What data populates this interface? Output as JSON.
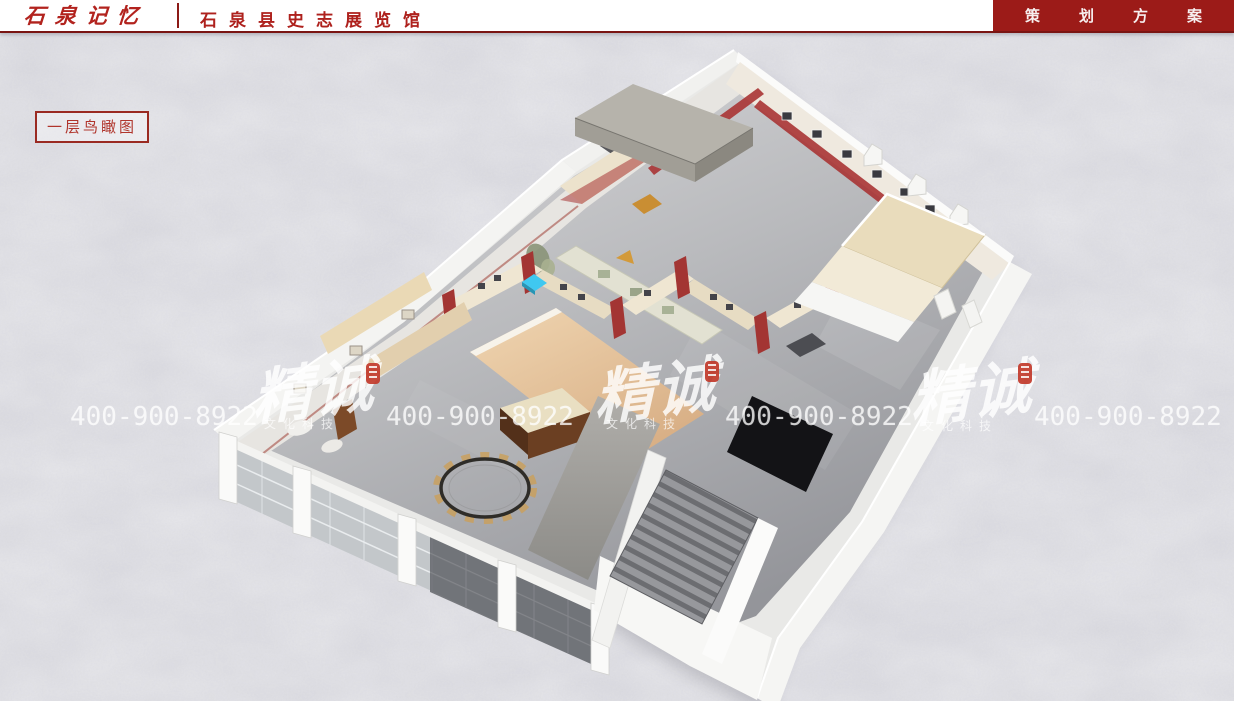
{
  "header": {
    "logo_text": "石泉记忆",
    "title": "石泉县史志展览馆",
    "menu_label": "策划方案"
  },
  "view": {
    "label": "一层鸟瞰图"
  },
  "watermark": {
    "phone": "400-900-8922",
    "brand": "精诚",
    "brand_subtitle": "文化科技"
  },
  "colors": {
    "brand_red": "#b2231e",
    "menu_bg": "#9c1b18",
    "header_rule": "#7a1513",
    "label_red": "#a8322a",
    "background": "#d8d8de",
    "watermark_text": "rgba(255,255,255,0.72)",
    "seal_red": "#c23a2b",
    "hotspot_cyan": "#3fc8f0",
    "exhibit_red": "#a33533",
    "canopy_beige": "#e9dcbc"
  }
}
